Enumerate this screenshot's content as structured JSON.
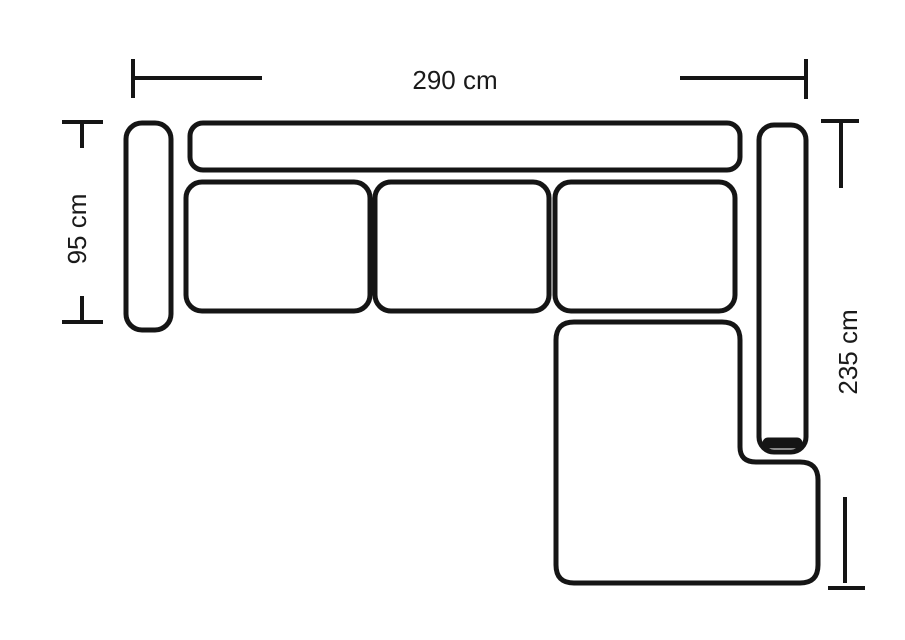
{
  "diagram": {
    "dimensions": {
      "width": {
        "label": "290 cm"
      },
      "depth": {
        "label": "95 cm"
      },
      "length": {
        "label": "235 cm"
      }
    }
  },
  "colors": {
    "line": "#151515",
    "background": "#ffffff",
    "text": "#1a1a1a"
  }
}
